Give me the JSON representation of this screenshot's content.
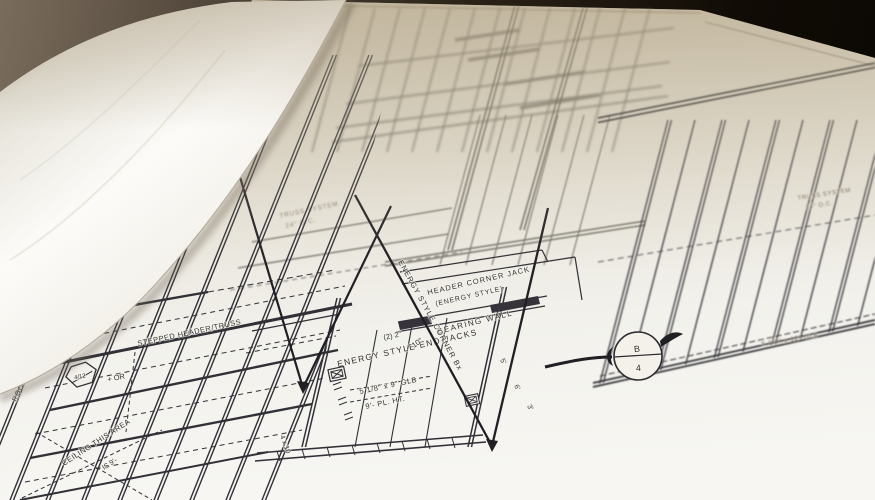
{
  "colors": {
    "paper_white": "#f6f5f1",
    "paper_tan": "#cfc7b6",
    "table_dark": "#17110a",
    "ink": "#313036"
  },
  "labels": {
    "header_corner_jack_1": "HEADER CORNER JACK",
    "header_corner_jack_2": "(ENERGY STYLE)",
    "bearing_wall": "BEARING WALL",
    "end_jacks": "ENERGY STYLE END JACKS",
    "corner_jack_diag": "ENERGY STYLE CORNER Bx",
    "glb_9": "5 1/8\" x 9\" GLB",
    "pl_ht": "9'- PL. HT.",
    "qty_2x2": "(2) 2\"",
    "qty_10": "10\"",
    "stepped_header": "STEPPED HEADER/TRUSS",
    "roof": "ROOF",
    "pitch": "4/12",
    "pitch_suffix": "+ OR",
    "ceiling_1": "CEILING THIS AREA",
    "ceiling_2": "IS 9'-",
    "truss_left_1": "TRUSS SYSTEM",
    "truss_left_2": "24\" O.C.",
    "truss_right_1": "TRUSS SYSTEM",
    "truss_right_2": "24\" O.C.",
    "glb_12": "5 1/8\" x 12\" GLB",
    "section_marker_top": "B",
    "section_marker_bottom": "4",
    "post_4x10": "4 x 10",
    "dim_5": "5'",
    "dim_6": "6'",
    "dim_3": "3'"
  },
  "symbols": {
    "section_marker": "circle-B-over-4-section-cut",
    "pitch_marker": "hexagon-roof-pitch",
    "register_box": "boxed-x-header-symbol",
    "leader_arrowhead": "filled-triangle-arrow"
  }
}
